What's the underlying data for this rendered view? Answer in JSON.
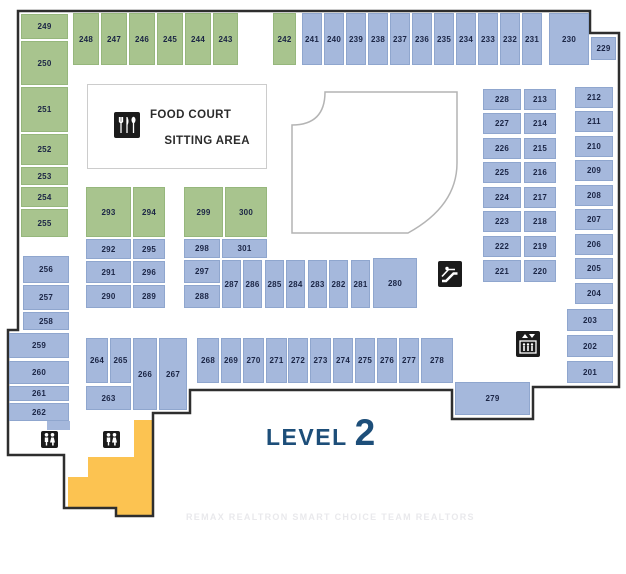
{
  "level": {
    "label": "LEVEL",
    "number": "2"
  },
  "food_court": {
    "line1": "FOOD COURT",
    "line2": "SITTING AREA"
  },
  "watermark": "REMAX REALTRON SMART CHOICE TEAM REALTORS",
  "colors": {
    "green": "#a8c48e",
    "green_border": "#96b77c",
    "blue": "#a5b8dc",
    "blue_border": "#8fa6ce",
    "unit_label": "#1b2545",
    "outline": "#2e2e2e",
    "open_area_border": "#b4b4b4",
    "stairs_fill": "#fcc351",
    "icon_bg": "#1b1b1b",
    "level_text": "#1d4e79"
  },
  "icons": {
    "food_court": "utensils-icon",
    "escalator": "escalator-icon",
    "elevator": "elevator-icon",
    "restroom_left": "restroom-icon",
    "restroom_right": "restroom-icon"
  },
  "units": [
    {
      "label": "249",
      "c": "g",
      "x": 21,
      "y": 14,
      "w": 47,
      "h": 25
    },
    {
      "label": "250",
      "c": "g",
      "x": 21,
      "y": 41,
      "w": 47,
      "h": 44
    },
    {
      "label": "251",
      "c": "g",
      "x": 21,
      "y": 87,
      "w": 47,
      "h": 45
    },
    {
      "label": "252",
      "c": "g",
      "x": 21,
      "y": 134,
      "w": 47,
      "h": 31
    },
    {
      "label": "253",
      "c": "g",
      "x": 21,
      "y": 167,
      "w": 47,
      "h": 18
    },
    {
      "label": "254",
      "c": "g",
      "x": 21,
      "y": 187,
      "w": 47,
      "h": 20
    },
    {
      "label": "255",
      "c": "g",
      "x": 21,
      "y": 209,
      "w": 47,
      "h": 28
    },
    {
      "label": "248",
      "c": "g",
      "x": 73,
      "y": 13,
      "w": 26,
      "h": 52
    },
    {
      "label": "247",
      "c": "g",
      "x": 101,
      "y": 13,
      "w": 26,
      "h": 52
    },
    {
      "label": "246",
      "c": "g",
      "x": 129,
      "y": 13,
      "w": 26,
      "h": 52
    },
    {
      "label": "245",
      "c": "g",
      "x": 157,
      "y": 13,
      "w": 26,
      "h": 52
    },
    {
      "label": "244",
      "c": "g",
      "x": 185,
      "y": 13,
      "w": 26,
      "h": 52
    },
    {
      "label": "243",
      "c": "g",
      "x": 213,
      "y": 13,
      "w": 25,
      "h": 52
    },
    {
      "label": "242",
      "c": "g",
      "x": 273,
      "y": 13,
      "w": 23,
      "h": 52
    },
    {
      "label": "241",
      "c": "b",
      "x": 302,
      "y": 13,
      "w": 20,
      "h": 52
    },
    {
      "label": "240",
      "c": "b",
      "x": 324,
      "y": 13,
      "w": 20,
      "h": 52
    },
    {
      "label": "239",
      "c": "b",
      "x": 346,
      "y": 13,
      "w": 20,
      "h": 52
    },
    {
      "label": "238",
      "c": "b",
      "x": 368,
      "y": 13,
      "w": 20,
      "h": 52
    },
    {
      "label": "237",
      "c": "b",
      "x": 390,
      "y": 13,
      "w": 20,
      "h": 52
    },
    {
      "label": "236",
      "c": "b",
      "x": 412,
      "y": 13,
      "w": 20,
      "h": 52
    },
    {
      "label": "235",
      "c": "b",
      "x": 434,
      "y": 13,
      "w": 20,
      "h": 52
    },
    {
      "label": "234",
      "c": "b",
      "x": 456,
      "y": 13,
      "w": 20,
      "h": 52
    },
    {
      "label": "233",
      "c": "b",
      "x": 478,
      "y": 13,
      "w": 20,
      "h": 52
    },
    {
      "label": "232",
      "c": "b",
      "x": 500,
      "y": 13,
      "w": 20,
      "h": 52
    },
    {
      "label": "231",
      "c": "b",
      "x": 522,
      "y": 13,
      "w": 20,
      "h": 52
    },
    {
      "label": "230",
      "c": "b",
      "x": 549,
      "y": 13,
      "w": 40,
      "h": 52
    },
    {
      "label": "229",
      "c": "b",
      "x": 591,
      "y": 37,
      "w": 25,
      "h": 23
    },
    {
      "label": "228",
      "c": "b",
      "x": 483,
      "y": 89,
      "w": 38,
      "h": 21
    },
    {
      "label": "213",
      "c": "b",
      "x": 524,
      "y": 89,
      "w": 32,
      "h": 21
    },
    {
      "label": "227",
      "c": "b",
      "x": 483,
      "y": 113,
      "w": 38,
      "h": 21
    },
    {
      "label": "214",
      "c": "b",
      "x": 524,
      "y": 113,
      "w": 32,
      "h": 21
    },
    {
      "label": "226",
      "c": "b",
      "x": 483,
      "y": 138,
      "w": 38,
      "h": 21
    },
    {
      "label": "215",
      "c": "b",
      "x": 524,
      "y": 138,
      "w": 32,
      "h": 21
    },
    {
      "label": "225",
      "c": "b",
      "x": 483,
      "y": 162,
      "w": 38,
      "h": 21
    },
    {
      "label": "216",
      "c": "b",
      "x": 524,
      "y": 162,
      "w": 32,
      "h": 21
    },
    {
      "label": "224",
      "c": "b",
      "x": 483,
      "y": 187,
      "w": 38,
      "h": 21
    },
    {
      "label": "217",
      "c": "b",
      "x": 524,
      "y": 187,
      "w": 32,
      "h": 21
    },
    {
      "label": "223",
      "c": "b",
      "x": 483,
      "y": 211,
      "w": 38,
      "h": 21
    },
    {
      "label": "218",
      "c": "b",
      "x": 524,
      "y": 211,
      "w": 32,
      "h": 21
    },
    {
      "label": "222",
      "c": "b",
      "x": 483,
      "y": 236,
      "w": 38,
      "h": 21
    },
    {
      "label": "219",
      "c": "b",
      "x": 524,
      "y": 236,
      "w": 32,
      "h": 21
    },
    {
      "label": "221",
      "c": "b",
      "x": 483,
      "y": 260,
      "w": 38,
      "h": 22
    },
    {
      "label": "220",
      "c": "b",
      "x": 524,
      "y": 260,
      "w": 32,
      "h": 22
    },
    {
      "label": "212",
      "c": "b",
      "x": 575,
      "y": 87,
      "w": 38,
      "h": 21
    },
    {
      "label": "211",
      "c": "b",
      "x": 575,
      "y": 111,
      "w": 38,
      "h": 21
    },
    {
      "label": "210",
      "c": "b",
      "x": 575,
      "y": 136,
      "w": 38,
      "h": 21
    },
    {
      "label": "209",
      "c": "b",
      "x": 575,
      "y": 160,
      "w": 38,
      "h": 21
    },
    {
      "label": "208",
      "c": "b",
      "x": 575,
      "y": 185,
      "w": 38,
      "h": 21
    },
    {
      "label": "207",
      "c": "b",
      "x": 575,
      "y": 209,
      "w": 38,
      "h": 21
    },
    {
      "label": "206",
      "c": "b",
      "x": 575,
      "y": 234,
      "w": 38,
      "h": 21
    },
    {
      "label": "205",
      "c": "b",
      "x": 575,
      "y": 258,
      "w": 38,
      "h": 21
    },
    {
      "label": "204",
      "c": "b",
      "x": 575,
      "y": 283,
      "w": 38,
      "h": 21
    },
    {
      "label": "203",
      "c": "b",
      "x": 567,
      "y": 309,
      "w": 46,
      "h": 22
    },
    {
      "label": "202",
      "c": "b",
      "x": 567,
      "y": 335,
      "w": 46,
      "h": 22
    },
    {
      "label": "201",
      "c": "b",
      "x": 567,
      "y": 361,
      "w": 46,
      "h": 22
    },
    {
      "label": "293",
      "c": "g",
      "x": 86,
      "y": 187,
      "w": 45,
      "h": 50
    },
    {
      "label": "294",
      "c": "g",
      "x": 133,
      "y": 187,
      "w": 32,
      "h": 50
    },
    {
      "label": "299",
      "c": "g",
      "x": 184,
      "y": 187,
      "w": 39,
      "h": 50
    },
    {
      "label": "300",
      "c": "g",
      "x": 225,
      "y": 187,
      "w": 42,
      "h": 50
    },
    {
      "label": "292",
      "c": "b",
      "x": 86,
      "y": 239,
      "w": 45,
      "h": 20
    },
    {
      "label": "295",
      "c": "b",
      "x": 133,
      "y": 239,
      "w": 32,
      "h": 20
    },
    {
      "label": "291",
      "c": "b",
      "x": 86,
      "y": 261,
      "w": 45,
      "h": 22
    },
    {
      "label": "296",
      "c": "b",
      "x": 133,
      "y": 261,
      "w": 32,
      "h": 22
    },
    {
      "label": "290",
      "c": "b",
      "x": 86,
      "y": 285,
      "w": 45,
      "h": 23
    },
    {
      "label": "289",
      "c": "b",
      "x": 133,
      "y": 285,
      "w": 32,
      "h": 23
    },
    {
      "label": "298",
      "c": "b",
      "x": 184,
      "y": 239,
      "w": 36,
      "h": 19
    },
    {
      "label": "301",
      "c": "b",
      "x": 222,
      "y": 239,
      "w": 45,
      "h": 19
    },
    {
      "label": "297",
      "c": "b",
      "x": 184,
      "y": 260,
      "w": 36,
      "h": 23
    },
    {
      "label": "288",
      "c": "b",
      "x": 184,
      "y": 285,
      "w": 36,
      "h": 23
    },
    {
      "label": "287",
      "c": "b",
      "x": 222,
      "y": 260,
      "w": 19,
      "h": 48
    },
    {
      "label": "286",
      "c": "b",
      "x": 243,
      "y": 260,
      "w": 19,
      "h": 48
    },
    {
      "label": "285",
      "c": "b",
      "x": 265,
      "y": 260,
      "w": 19,
      "h": 48
    },
    {
      "label": "284",
      "c": "b",
      "x": 286,
      "y": 260,
      "w": 19,
      "h": 48
    },
    {
      "label": "283",
      "c": "b",
      "x": 308,
      "y": 260,
      "w": 19,
      "h": 48
    },
    {
      "label": "282",
      "c": "b",
      "x": 329,
      "y": 260,
      "w": 19,
      "h": 48
    },
    {
      "label": "281",
      "c": "b",
      "x": 351,
      "y": 260,
      "w": 19,
      "h": 48
    },
    {
      "label": "280",
      "c": "b",
      "x": 373,
      "y": 258,
      "w": 44,
      "h": 50
    },
    {
      "label": "256",
      "c": "b",
      "x": 23,
      "y": 256,
      "w": 46,
      "h": 27
    },
    {
      "label": "257",
      "c": "b",
      "x": 23,
      "y": 285,
      "w": 46,
      "h": 25
    },
    {
      "label": "258",
      "c": "b",
      "x": 23,
      "y": 312,
      "w": 46,
      "h": 18
    },
    {
      "label": "259",
      "c": "b",
      "x": 9,
      "y": 333,
      "w": 60,
      "h": 25
    },
    {
      "label": "260",
      "c": "b",
      "x": 9,
      "y": 361,
      "w": 60,
      "h": 23
    },
    {
      "label": "261",
      "c": "b",
      "x": 9,
      "y": 386,
      "w": 60,
      "h": 15
    },
    {
      "label": "262",
      "c": "b",
      "x": 9,
      "y": 403,
      "w": 60,
      "h": 18
    },
    {
      "label": "264",
      "c": "b",
      "x": 86,
      "y": 338,
      "w": 22,
      "h": 45
    },
    {
      "label": "265",
      "c": "b",
      "x": 110,
      "y": 338,
      "w": 21,
      "h": 45
    },
    {
      "label": "266",
      "c": "b",
      "x": 133,
      "y": 338,
      "w": 24,
      "h": 72
    },
    {
      "label": "267",
      "c": "b",
      "x": 159,
      "y": 338,
      "w": 28,
      "h": 72
    },
    {
      "label": "263",
      "c": "b",
      "x": 86,
      "y": 386,
      "w": 45,
      "h": 24
    },
    {
      "label": "268",
      "c": "b",
      "x": 197,
      "y": 338,
      "w": 22,
      "h": 45
    },
    {
      "label": "269",
      "c": "b",
      "x": 221,
      "y": 338,
      "w": 20,
      "h": 45
    },
    {
      "label": "270",
      "c": "b",
      "x": 243,
      "y": 338,
      "w": 21,
      "h": 45
    },
    {
      "label": "271",
      "c": "b",
      "x": 266,
      "y": 338,
      "w": 21,
      "h": 45
    },
    {
      "label": "272",
      "c": "b",
      "x": 288,
      "y": 338,
      "w": 20,
      "h": 45
    },
    {
      "label": "273",
      "c": "b",
      "x": 310,
      "y": 338,
      "w": 21,
      "h": 45
    },
    {
      "label": "274",
      "c": "b",
      "x": 333,
      "y": 338,
      "w": 20,
      "h": 45
    },
    {
      "label": "275",
      "c": "b",
      "x": 355,
      "y": 338,
      "w": 20,
      "h": 45
    },
    {
      "label": "276",
      "c": "b",
      "x": 377,
      "y": 338,
      "w": 20,
      "h": 45
    },
    {
      "label": "277",
      "c": "b",
      "x": 399,
      "y": 338,
      "w": 20,
      "h": 45
    },
    {
      "label": "278",
      "c": "b",
      "x": 421,
      "y": 338,
      "w": 32,
      "h": 45
    },
    {
      "label": "279",
      "c": "b",
      "x": 455,
      "y": 382,
      "w": 75,
      "h": 33
    }
  ]
}
